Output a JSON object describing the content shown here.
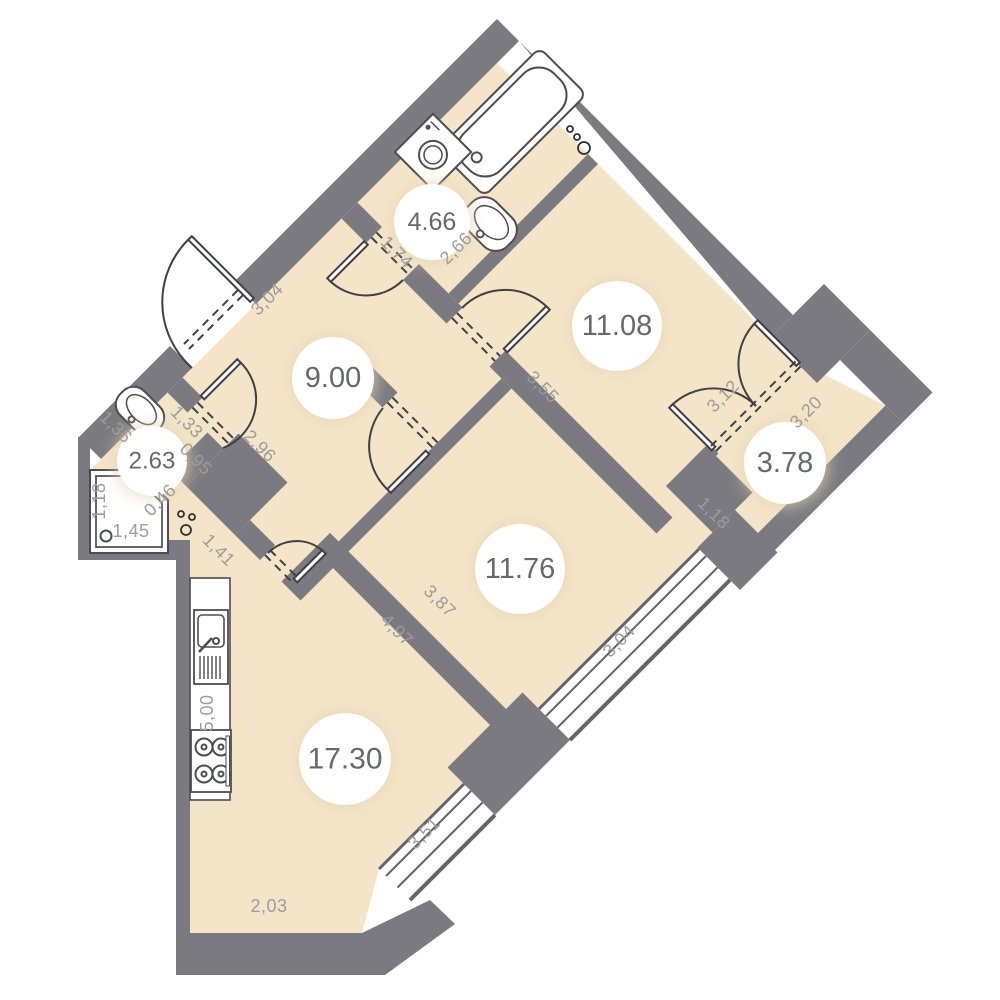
{
  "plan": {
    "type": "apartment-floor-plan",
    "colors": {
      "floor": "#f4e5c8",
      "wall": "#7a7a80",
      "dim_text": "#9c9c9c",
      "area_text": "#67686c",
      "fixture_stroke": "#4c4d52",
      "door_stroke": "#3f4045",
      "white": "#ffffff"
    },
    "rooms": [
      {
        "name": "bathroom",
        "area": "4.66",
        "cx": 432,
        "cy": 222,
        "r": 38,
        "fs": 25
      },
      {
        "name": "hallway",
        "area": "9.00",
        "cx": 333,
        "cy": 378,
        "r": 41,
        "fs": 29
      },
      {
        "name": "living-room",
        "area": "11.08",
        "cx": 617,
        "cy": 326,
        "r": 45,
        "fs": 29
      },
      {
        "name": "shower-wc",
        "area": "2.63",
        "cx": 152,
        "cy": 461,
        "r": 35,
        "fs": 24
      },
      {
        "name": "balcony",
        "area": "3.78",
        "cx": 785,
        "cy": 463,
        "r": 41,
        "fs": 29
      },
      {
        "name": "bedroom",
        "area": "11.76",
        "cx": 520,
        "cy": 569,
        "r": 45,
        "fs": 29
      },
      {
        "name": "kitchen-living-room",
        "area": "17.30",
        "cx": 345,
        "cy": 759,
        "r": 46,
        "fs": 30
      }
    ],
    "dimensions": [
      {
        "text": "1,74",
        "x": 397,
        "y": 252,
        "rot": 45
      },
      {
        "text": "2,66",
        "x": 456,
        "y": 248,
        "rot": -45
      },
      {
        "text": "3,04",
        "x": 267,
        "y": 299,
        "rot": -45
      },
      {
        "text": "3,55",
        "x": 543,
        "y": 387,
        "rot": 45
      },
      {
        "text": "3,12",
        "x": 723,
        "y": 396,
        "rot": -45
      },
      {
        "text": "3,20",
        "x": 806,
        "y": 412,
        "rot": -45
      },
      {
        "text": "1,18",
        "x": 714,
        "y": 513,
        "rot": 45
      },
      {
        "text": "1,36",
        "x": 116,
        "y": 427,
        "rot": 45
      },
      {
        "text": "1,33",
        "x": 187,
        "y": 422,
        "rot": 45
      },
      {
        "text": "0,95",
        "x": 196,
        "y": 459,
        "rot": 45
      },
      {
        "text": "2,96",
        "x": 260,
        "y": 446,
        "rot": 45
      },
      {
        "text": "0,46",
        "x": 160,
        "y": 500,
        "rot": -45
      },
      {
        "text": "1,41",
        "x": 219,
        "y": 550,
        "rot": 45
      },
      {
        "text": "1,18",
        "x": 99,
        "y": 501,
        "rot": -90
      },
      {
        "text": "1,45",
        "x": 131,
        "y": 531,
        "rot": 0
      },
      {
        "text": "4,97",
        "x": 397,
        "y": 630,
        "rot": 45
      },
      {
        "text": "3,87",
        "x": 440,
        "y": 601,
        "rot": 45
      },
      {
        "text": "3,04",
        "x": 619,
        "y": 641,
        "rot": -45
      },
      {
        "text": "3,51",
        "x": 424,
        "y": 833,
        "rot": -45
      },
      {
        "text": "5,00",
        "x": 207,
        "y": 713,
        "rot": -90
      },
      {
        "text": "2,03",
        "x": 269,
        "y": 906,
        "rot": 0
      }
    ],
    "riser_dots": [
      {
        "cx": 570,
        "cy": 129,
        "r": 3
      },
      {
        "cx": 577,
        "cy": 137,
        "r": 3
      },
      {
        "cx": 584,
        "cy": 148,
        "r": 6
      },
      {
        "cx": 181,
        "cy": 514,
        "r": 3
      },
      {
        "cx": 192,
        "cy": 517,
        "r": 3
      },
      {
        "cx": 186,
        "cy": 530,
        "r": 5
      }
    ],
    "fixtures": [
      "bathtub",
      "washing-machine",
      "bathroom-sink",
      "wc-sink",
      "shower-cabin",
      "kitchen-counter",
      "kitchen-sink",
      "stove"
    ]
  }
}
